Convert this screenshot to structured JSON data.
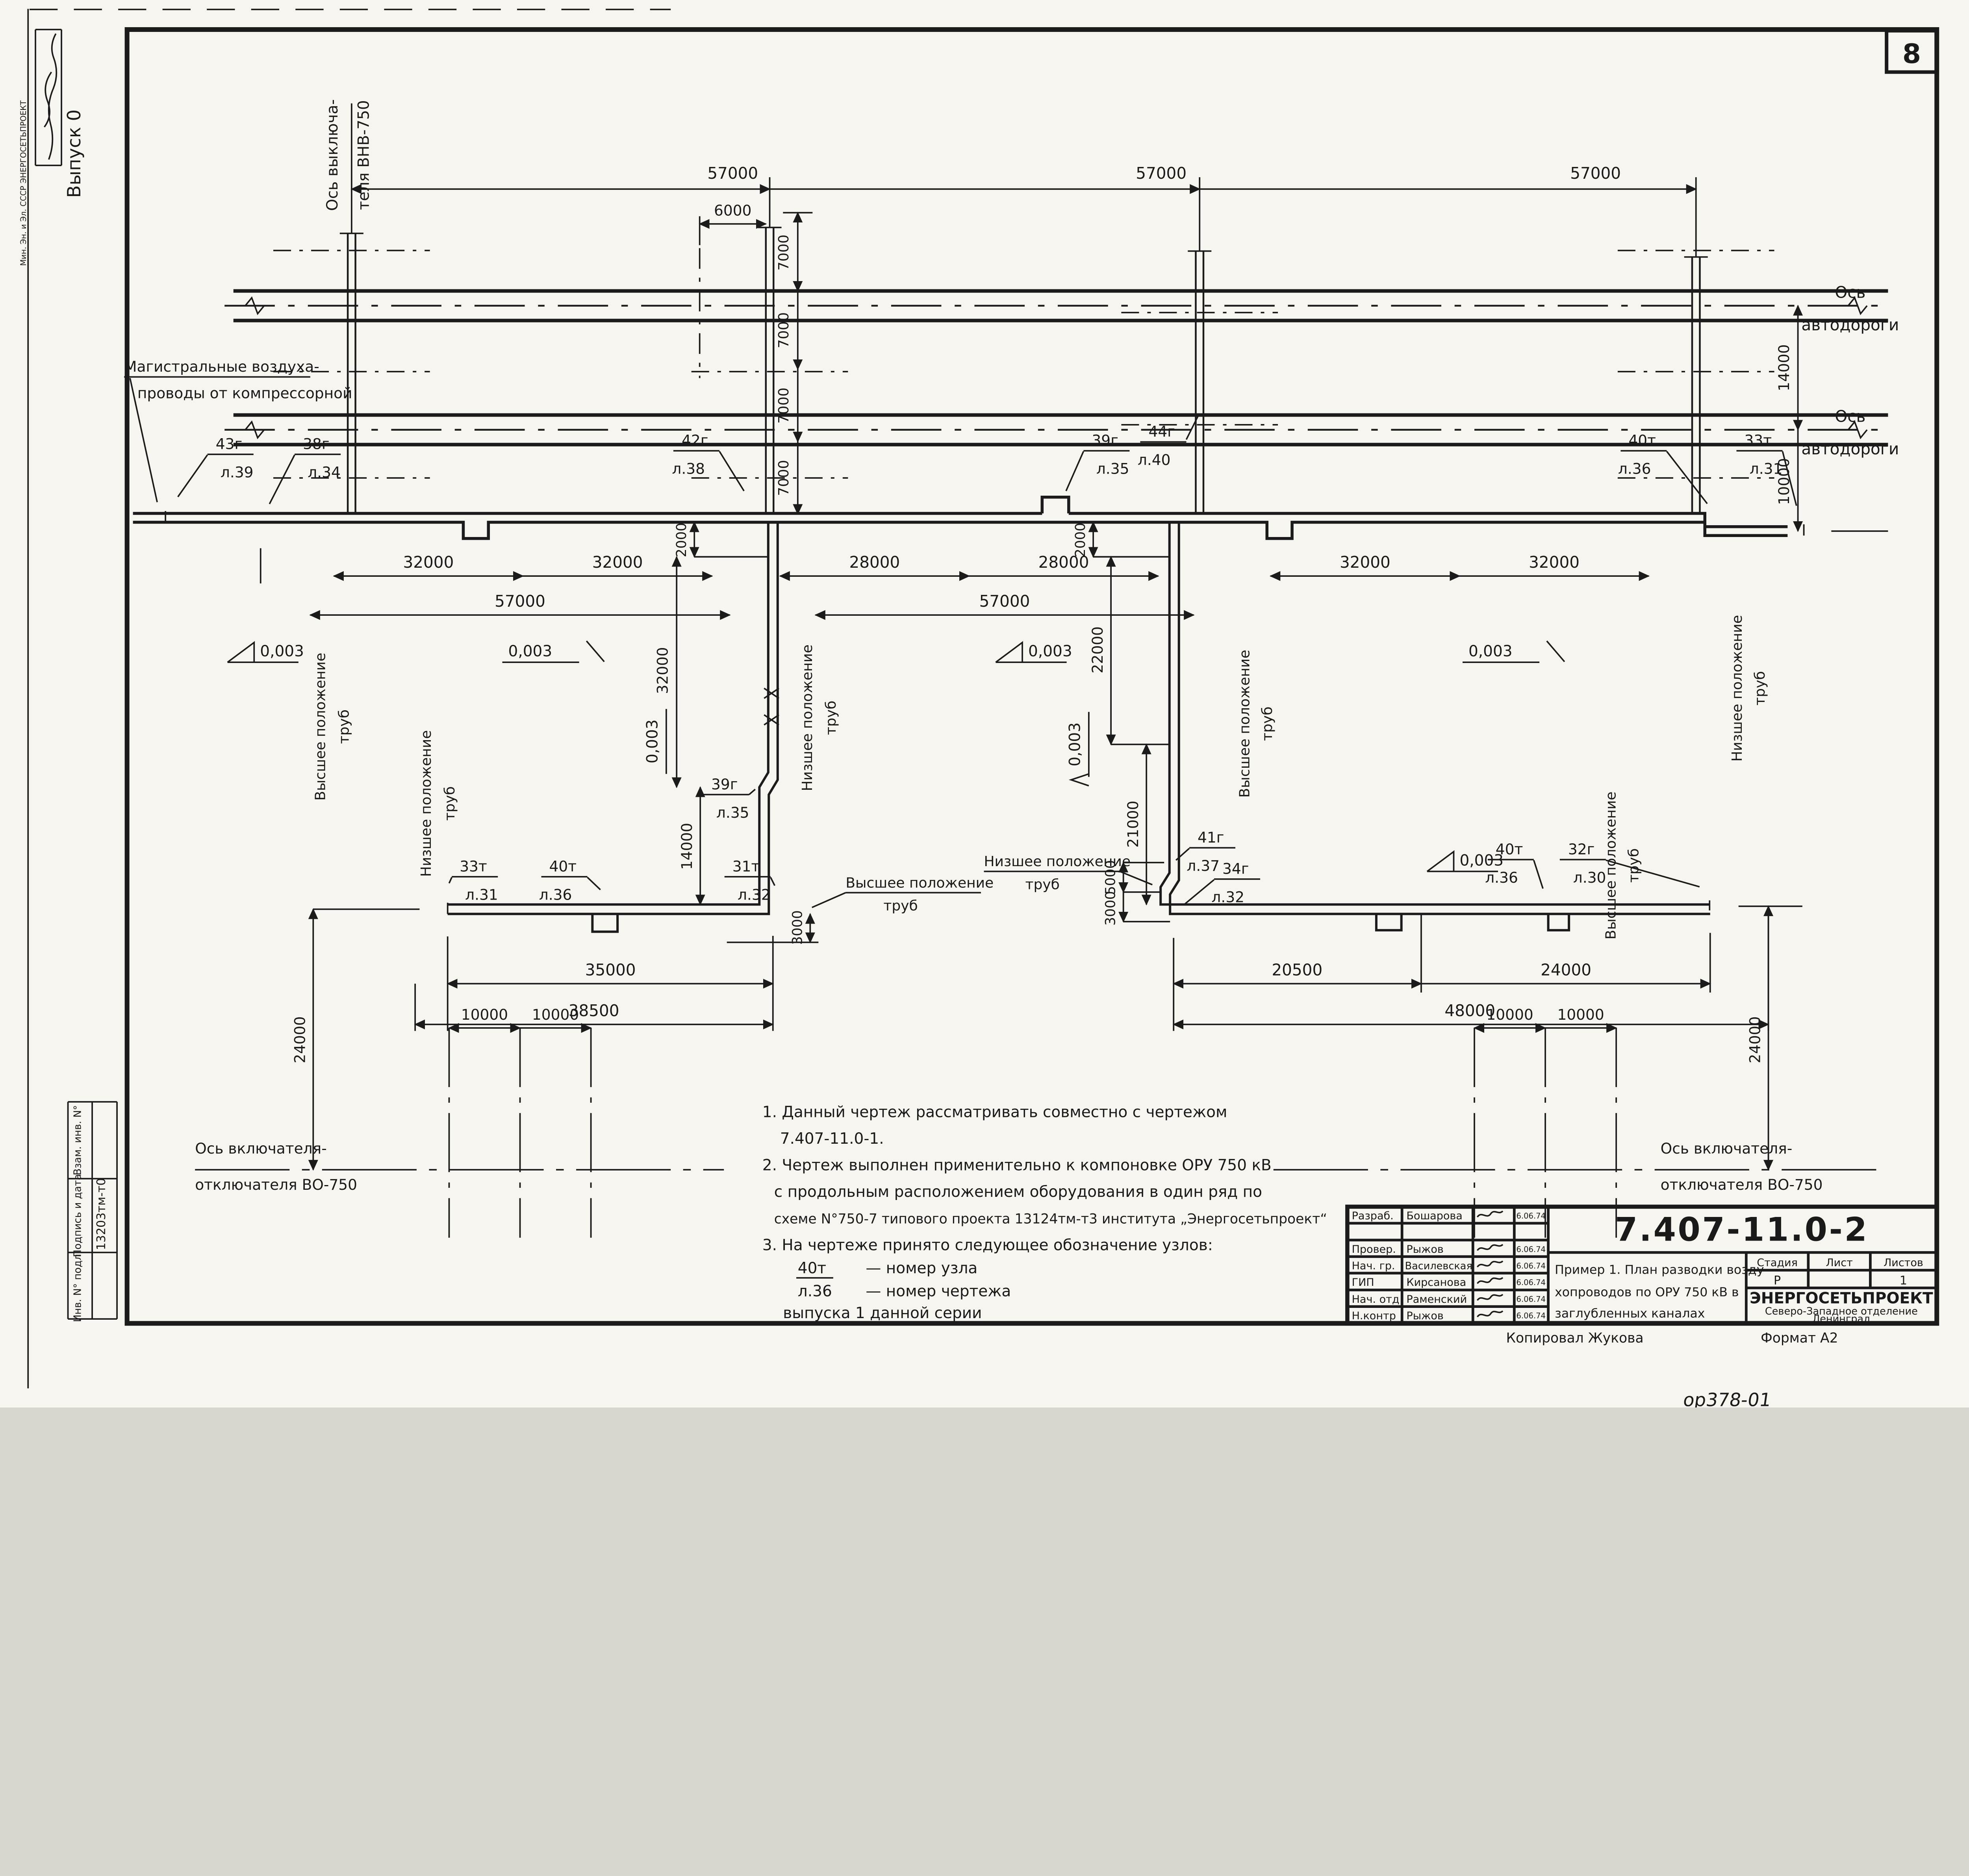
{
  "page": {
    "number": "8",
    "footer_code": "ор378-01",
    "format": "Формат А2",
    "copied_by": "Копировал Жукова",
    "issue": "Выпуск 0",
    "ministry_stamp": "Мин. Эн. и Эл. СССР   ЭНЕРГОСЕТЬПРОЕКТ",
    "side_table": {
      "row1": "Взам. инв. N°",
      "row2": "Подпись и дата",
      "row3": "Инв. N° подл.",
      "code": "13203тм-т0"
    }
  },
  "labels": {
    "breaker_axis_1": "Ось выключа-",
    "breaker_axis_2": "теля ВНВ-750",
    "main_air_1": "Магистральные воздуха-",
    "main_air_2": "проводы от компрессорной",
    "road_axis_1": "Ось",
    "road_axis_2": "автодороги",
    "pos_high_1": "Высшее положение",
    "pos_high_2": "труб",
    "pos_low_1": "Низшее положение",
    "pos_low_2": "труб",
    "bottom_axis_1": "Ось  включателя-",
    "bottom_axis_2": "отключателя ВО-750",
    "slope": "0,003"
  },
  "dims": {
    "d57000": "57000",
    "d6000": "6000",
    "d7000": "7000",
    "d32000": "32000",
    "d28000": "28000",
    "d2000": "2000",
    "d22000": "22000",
    "d21000": "21000",
    "d14000": "14000",
    "d10000": "10000",
    "d5000": "5000",
    "d3000": "3000",
    "d35000": "35000",
    "d38500": "38500",
    "d20500": "20500",
    "d24000": "24000",
    "d48000": "48000"
  },
  "nodes": {
    "n43": {
      "t": "43г",
      "s": "л.39"
    },
    "n38": {
      "t": "38г",
      "s": "л.34"
    },
    "n42": {
      "t": "42г",
      "s": "л.38"
    },
    "n39": {
      "t": "39г",
      "s": "л.35"
    },
    "n44": {
      "t": "44г",
      "s": "л.40"
    },
    "n40": {
      "t": "40т",
      "s": "л.36"
    },
    "n33": {
      "t": "33т",
      "s": "л.31"
    },
    "n31": {
      "t": "31т",
      "s": "л.32"
    },
    "n41": {
      "t": "41г",
      "s": "л.37"
    },
    "n34": {
      "t": "34г",
      "s": "л.32"
    },
    "n32": {
      "t": "32г",
      "s": "л.30"
    }
  },
  "notes": {
    "l1": "1.  Данный  чертеж  рассматривать  совместно  с  чертежом",
    "l2": "7.407-11.0-1.",
    "l3": "2.  Чертеж  выполнен  применительно  к  компоновке  ОРУ 750 кВ",
    "l4": "с продольным  расположением  оборудования  в один  ряд  по",
    "l5": "схеме  N°750-7  типового  проекта  13124тм-т3  института „Энергосетьпроект“",
    "l6": "3.  На  чертеже  принято  следующее  обозначение  узлов:",
    "l7a": "40т",
    "l7b": "— номер  узла",
    "l8a": "л.36",
    "l8b": "— номер  чертежа",
    "l9": "выпуска 1 данной  серии"
  },
  "title_block": {
    "doc_number": "7.407-11.0-2",
    "rows": [
      {
        "role": "Разраб.",
        "name": "Бошарова",
        "date": "6.06.74"
      },
      {
        "role": "",
        "name": "",
        "date": ""
      },
      {
        "role": "Провер.",
        "name": "Рыжов",
        "date": "6.06.74"
      },
      {
        "role": "Нач. гр.",
        "name": "Василевская",
        "date": "6.06.74"
      },
      {
        "role": "ГИП",
        "name": "Кирсанова",
        "date": "6.06.74"
      },
      {
        "role": "Нач. отд",
        "name": "Раменский",
        "date": "6.06.74"
      },
      {
        "role": "Н.контр",
        "name": "Рыжов",
        "date": "6.06.74"
      }
    ],
    "title_1": "Пример 1. План разводки возду-",
    "title_2": "хопроводов по ОРУ 750 кВ в",
    "title_3": "заглубленных каналах",
    "stage_label": "Стадия",
    "sheet_label": "Лист",
    "sheets_label": "Листов",
    "stage": "Р",
    "sheet": "",
    "sheets": "1",
    "org_1": "ЭНЕРГОСЕТЬПРОЕКТ",
    "org_2": "Северо-Западное отделение",
    "org_3": "Ленинград"
  }
}
